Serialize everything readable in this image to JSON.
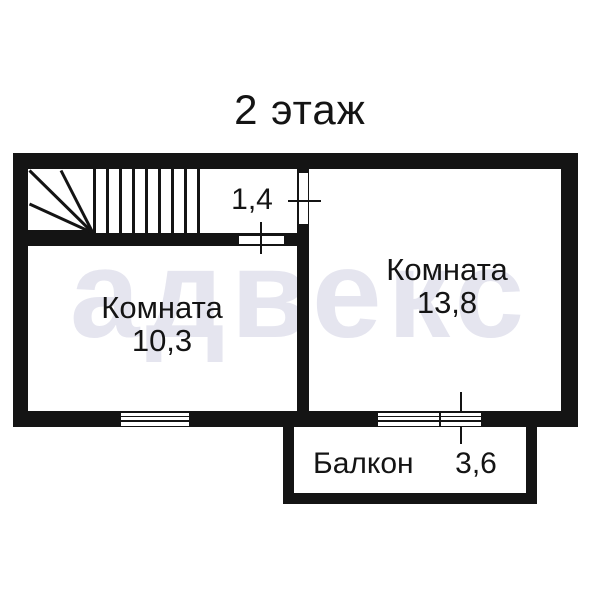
{
  "title": "2 этаж",
  "watermark": "адвекс",
  "plan": {
    "hall": {
      "area": "1,4"
    },
    "room_left": {
      "name": "Комната",
      "area": "10,3"
    },
    "room_right": {
      "name": "Комната",
      "area": "13,8"
    },
    "balcony": {
      "name": "Балкон",
      "area": "3,6"
    }
  },
  "colors": {
    "wall": "#141414",
    "label_text": "#141414",
    "watermark": "#e5e5ef",
    "background": "#ffffff"
  }
}
